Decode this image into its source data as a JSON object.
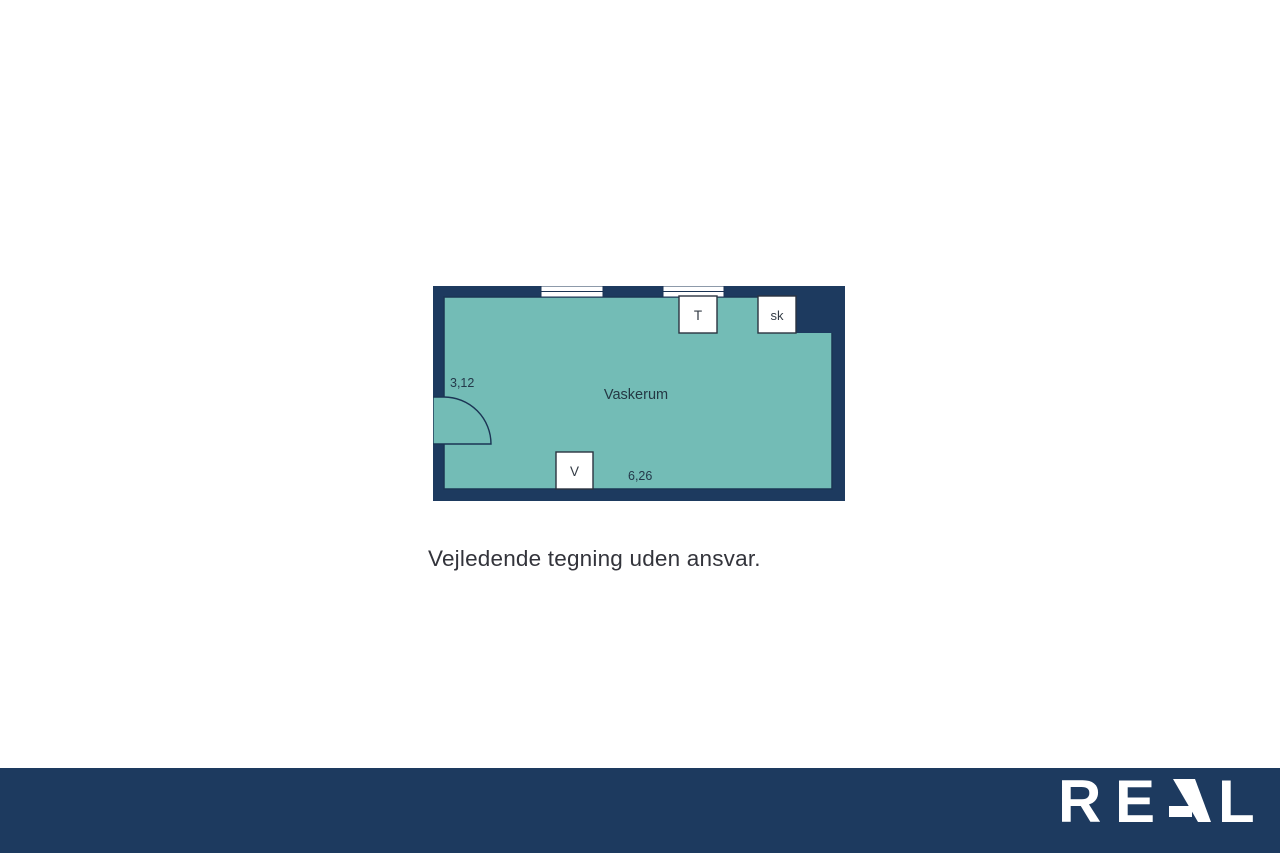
{
  "floorplan": {
    "room_label": "Vaskerum",
    "dim_left": "3,12",
    "dim_bottom": "6,26",
    "fixtures": {
      "t": "T",
      "sk": "sk",
      "v": "V"
    },
    "colors": {
      "wall_navy": "#1d3a5f",
      "floor_teal": "#73bcb6",
      "fixture_white": "#ffffff"
    }
  },
  "caption": "Vejledende tegning uden ansvar.",
  "footer": {
    "bg_color": "#1d3a5f",
    "logo_text": "REAL",
    "logo_letters": {
      "r": "R",
      "e": "E",
      "a": "A",
      "l": "L"
    },
    "logo_color": "#ffffff"
  }
}
